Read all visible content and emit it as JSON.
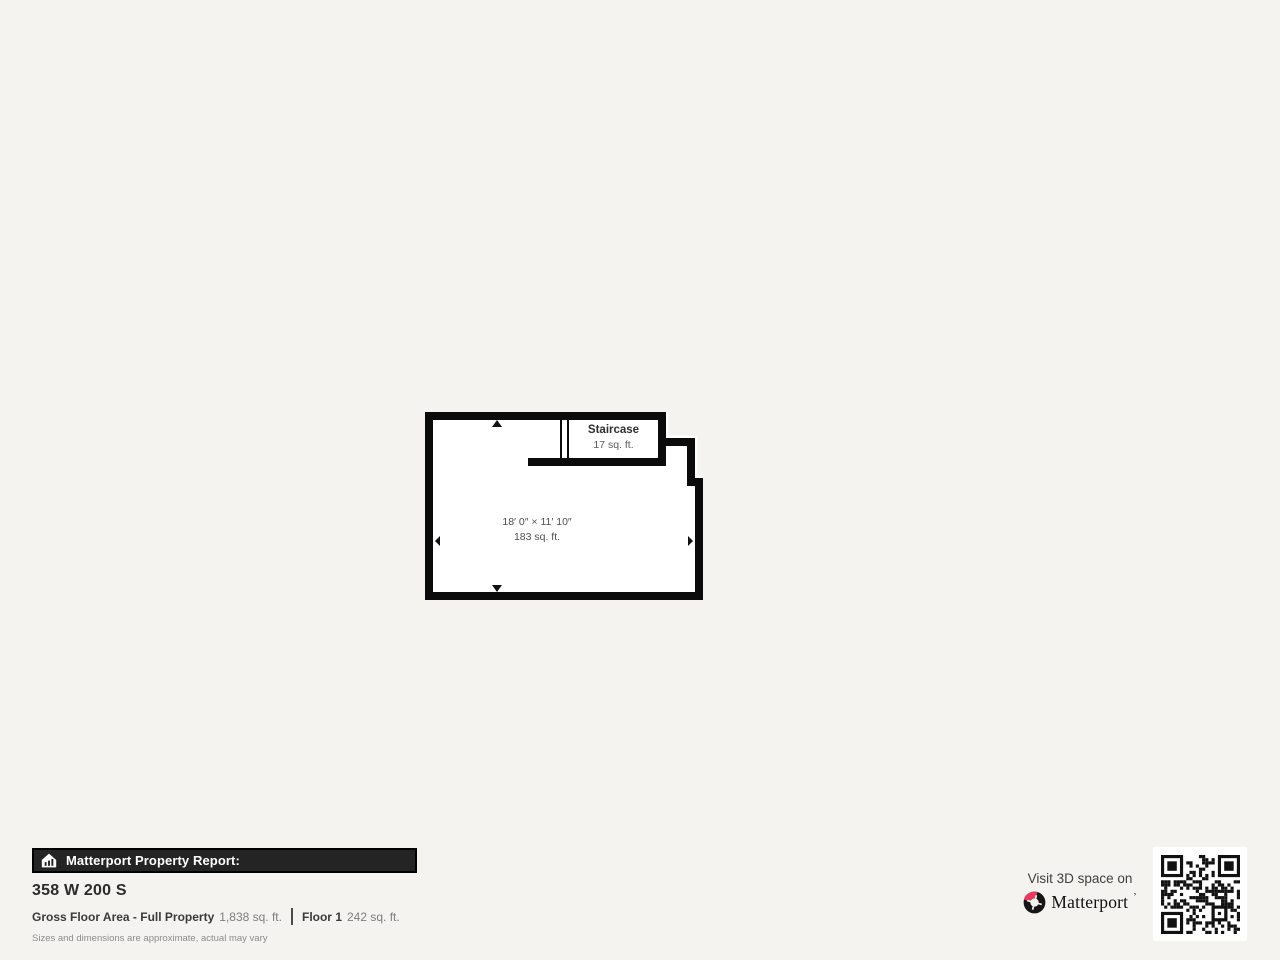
{
  "page": {
    "background_color": "#f4f3f0"
  },
  "floorplan": {
    "wall_color": "#0b0b0b",
    "room": {
      "dimensions": "18′ 0″ × 11′ 10″",
      "area": "183 sq. ft."
    },
    "staircase": {
      "label": "Staircase",
      "area": "17 sq. ft."
    }
  },
  "report": {
    "header": "Matterport Property Report:",
    "address": "358 W 200 S",
    "gross_label": "Gross Floor Area - Full Property",
    "gross_value": "1,838 sq. ft.",
    "floor_label": "Floor 1",
    "floor_value": "242 sq. ft.",
    "disclaimer": "Sizes and dimensions are approximate, actual may vary"
  },
  "promo": {
    "visit_text": "Visit 3D space on",
    "brand": "Matterport",
    "trademark": "’",
    "brand_accent_color": "#e8395f"
  }
}
